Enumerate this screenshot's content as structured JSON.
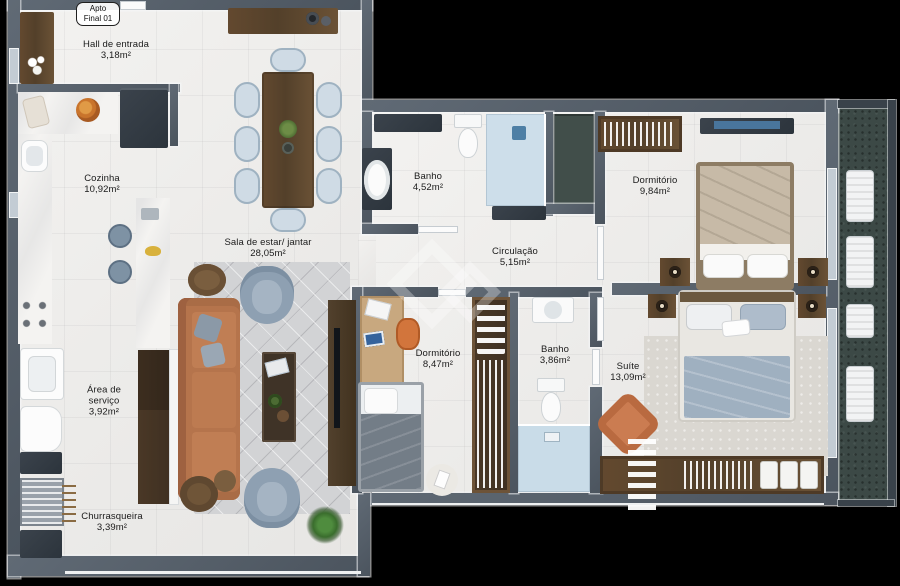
{
  "badge": {
    "line1": "Apto",
    "line2": "Final 01"
  },
  "rooms": [
    {
      "id": "hall-de-entrada",
      "name": "Hall de entrada",
      "area": "3,18m²"
    },
    {
      "id": "cozinha",
      "name": "Cozinha",
      "area": "10,92m²"
    },
    {
      "id": "sala-estar-jantar",
      "name": "Sala de estar/ jantar",
      "area": "28,05m²"
    },
    {
      "id": "banho-social",
      "name": "Banho",
      "area": "4,52m²"
    },
    {
      "id": "dormitorio-1",
      "name": "Dormitório",
      "area": "9,84m²"
    },
    {
      "id": "circulacao",
      "name": "Circulação",
      "area": "5,15m²"
    },
    {
      "id": "dormitorio-2",
      "name": "Dormitório",
      "area": "8,47m²"
    },
    {
      "id": "banho-suite",
      "name": "Banho",
      "area": "3,86m²"
    },
    {
      "id": "suite",
      "name": "Suíte",
      "area": "13,09m²"
    },
    {
      "id": "area-de-servico",
      "name": "Área de serviço",
      "area": "3,92m²"
    },
    {
      "id": "churrasqueira",
      "name": "Churrasqueira",
      "area": "3,39m²"
    }
  ],
  "palette": {
    "background": "#000000",
    "wall": "#57616c",
    "floor": "#edecea",
    "marble": "#f4f3f1",
    "wood_dark": "#5c4732",
    "wood_light": "#c8a87f",
    "sofa_terracotta": "#b5744c",
    "upholstery_blue_gray": "#8ea0b2",
    "dining_chair_blue": "#cfdbe5",
    "rug_gray": "#d3d4d6",
    "balcony_floor_teal": "#3c4946",
    "accent_orange_chair": "#cb7c51",
    "shower_tile_blue": "#cddeea",
    "blanket_beige": "#c7baa7",
    "blanket_gray_blue": "#9fb0c0"
  }
}
